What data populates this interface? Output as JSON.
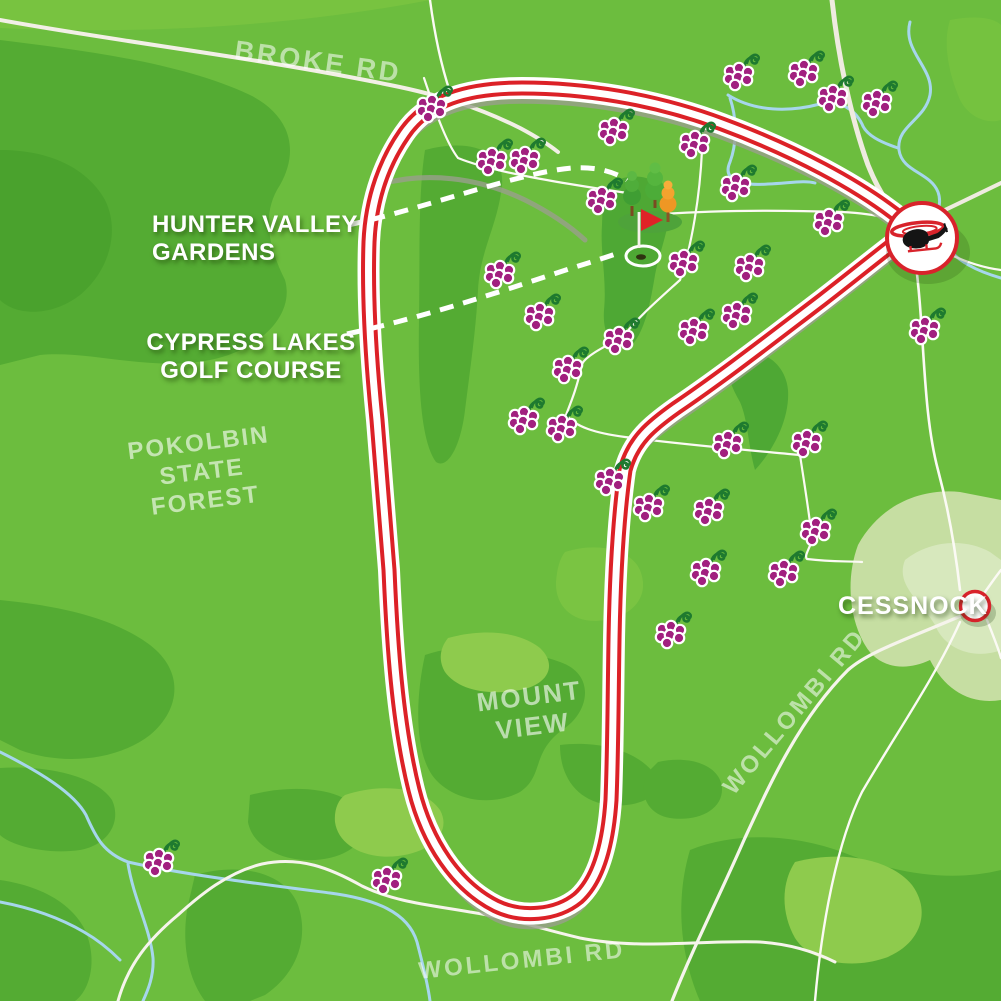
{
  "map": {
    "title": "Hunter Valley helicopter route map",
    "region_labels": {
      "broke_rd": "BROKE RD",
      "pokolbin_l1": "POKOLBIN",
      "pokolbin_l2": "STATE",
      "pokolbin_l3": "FOREST",
      "mount_view_l1": "MOUNT",
      "mount_view_l2": "VIEW",
      "wollombi_rd_right": "WOLLOMBI RD",
      "wollombi_rd_bottom": "WOLLOMBI RD"
    },
    "poi_labels": {
      "hunter_l1": "HUNTER VALLEY",
      "hunter_l2": "GARDENS",
      "cypress_l1": "CYPRESS LAKES",
      "cypress_l2": "GOLF COURSE",
      "cessnock": "CESSNOCK"
    },
    "icons": {
      "helicopter": "helicopter-icon",
      "grape": "grape-cluster-icon",
      "golf_flag": "golf-flag-icon",
      "trees": "tree-icons",
      "town_marker": "town-circle-marker"
    },
    "colors": {
      "base_green": "#6CBD3E",
      "dark_green": "#54AB33",
      "darker_green": "#4AA22D",
      "pale_town": "#C6DEA2",
      "route_red": "#DC2127",
      "route_white": "#FFFFFF",
      "road_cream": "#EFEBE0",
      "road_shadow_gray": "#99A08C",
      "creek_blue": "#A6D6EC",
      "grape_purple": "#A1207F",
      "stem_green": "#1E7A2F",
      "flag_red": "#E02227"
    },
    "grapes": [
      [
        435,
        104
      ],
      [
        495,
        157
      ],
      [
        528,
        156
      ],
      [
        617,
        127
      ],
      [
        605,
        196
      ],
      [
        698,
        140
      ],
      [
        739,
        183
      ],
      [
        742,
        72
      ],
      [
        807,
        69
      ],
      [
        836,
        94
      ],
      [
        880,
        99
      ],
      [
        832,
        218
      ],
      [
        928,
        326
      ],
      [
        503,
        270
      ],
      [
        543,
        312
      ],
      [
        571,
        365
      ],
      [
        622,
        336
      ],
      [
        687,
        259
      ],
      [
        753,
        263
      ],
      [
        697,
        327
      ],
      [
        740,
        311
      ],
      [
        527,
        416
      ],
      [
        565,
        424
      ],
      [
        613,
        477
      ],
      [
        652,
        503
      ],
      [
        712,
        507
      ],
      [
        731,
        440
      ],
      [
        810,
        439
      ],
      [
        819,
        527
      ],
      [
        709,
        568
      ],
      [
        787,
        569
      ],
      [
        674,
        630
      ],
      [
        162,
        858
      ],
      [
        390,
        876
      ]
    ]
  }
}
